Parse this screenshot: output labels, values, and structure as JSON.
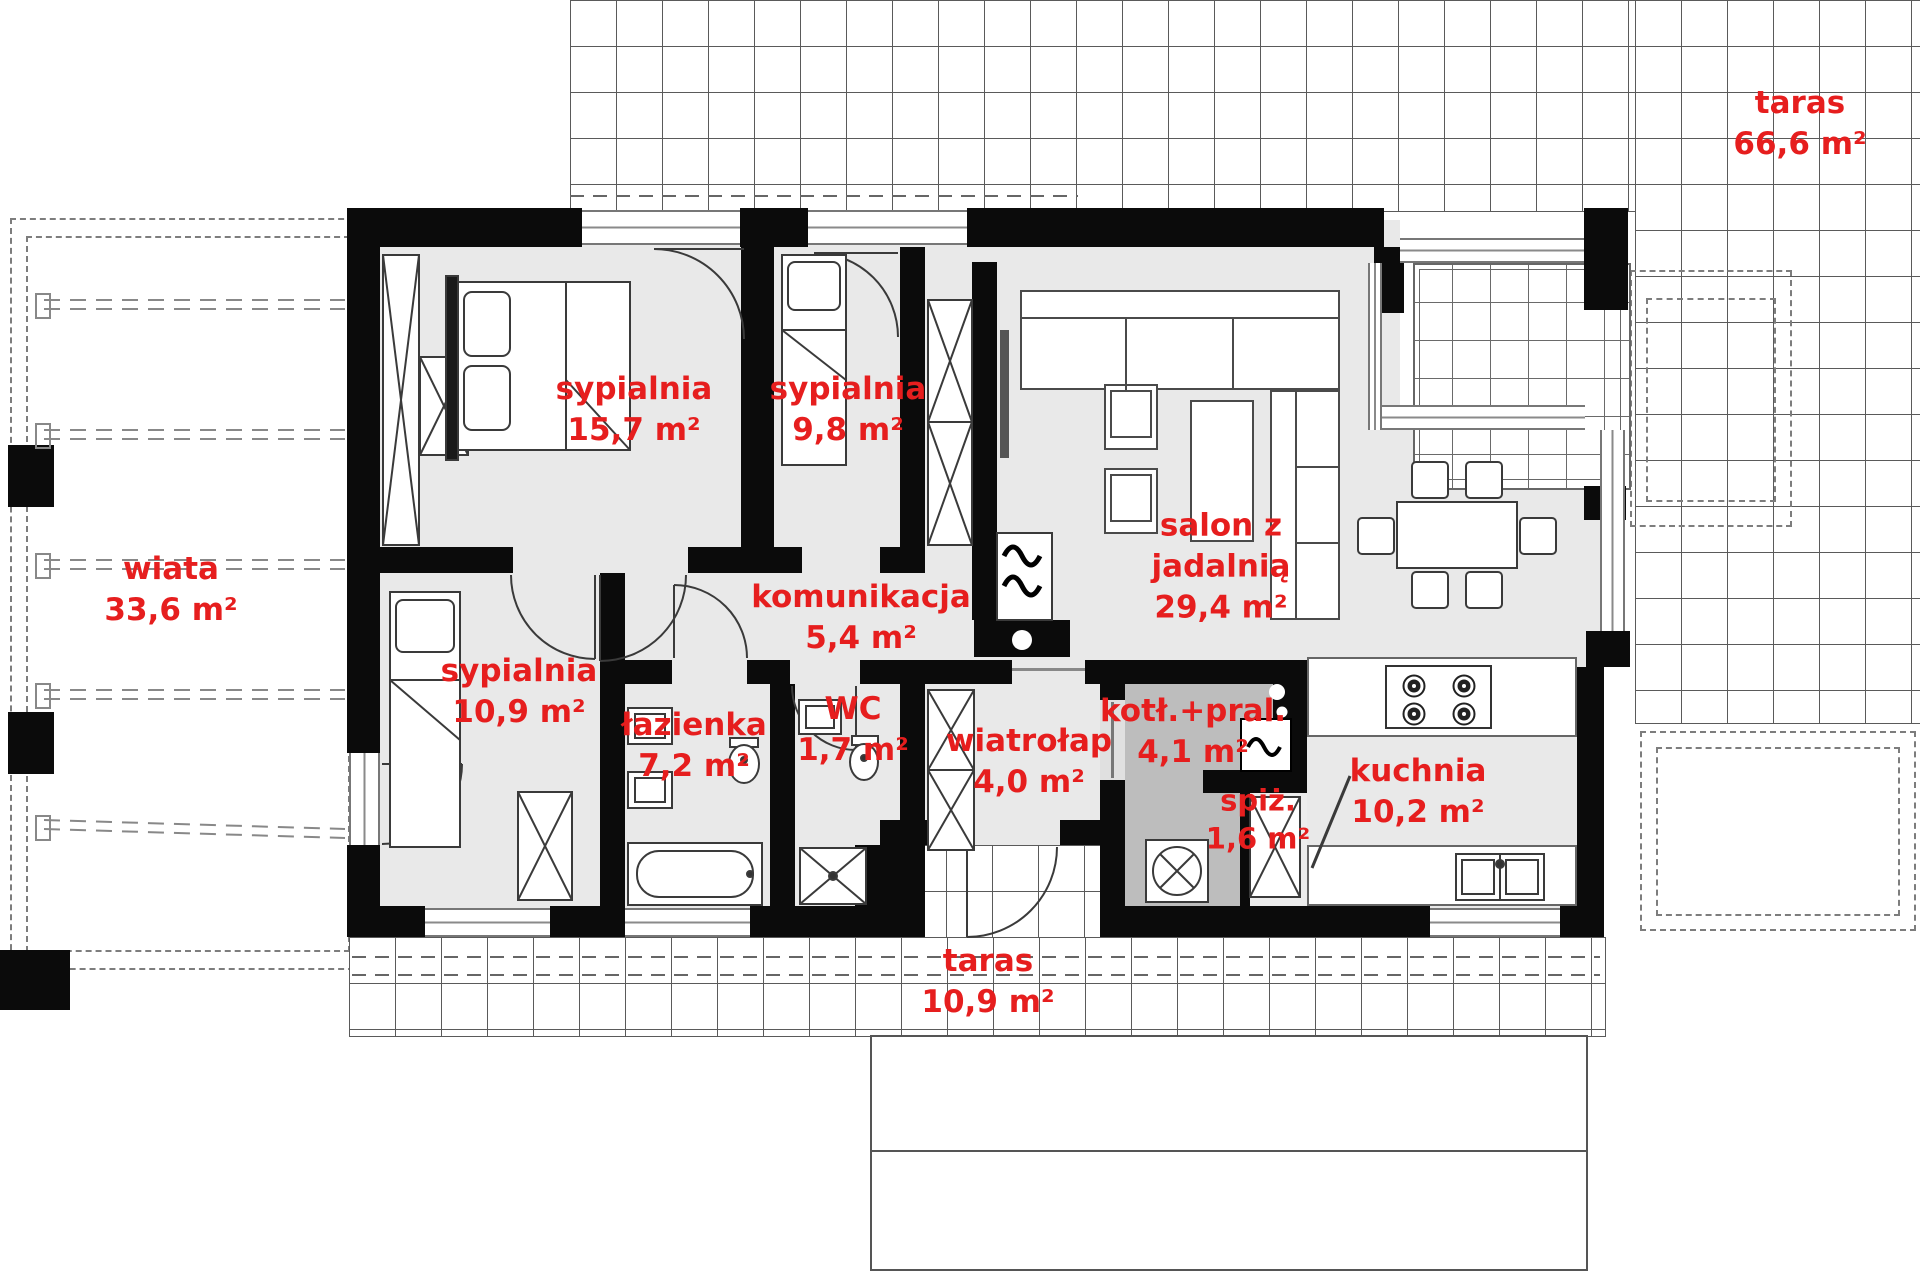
{
  "rooms": [
    {
      "name": "taras",
      "area": "66,6 m²"
    },
    {
      "name": "wiata",
      "area": "33,6 m²"
    },
    {
      "name": "sypialnia",
      "area": "15,7 m²"
    },
    {
      "name": "sypialnia",
      "area": "9,8 m²"
    },
    {
      "name": "salon z jadalnią",
      "area": "29,4 m²"
    },
    {
      "name": "komunikacja",
      "area": "5,4 m²"
    },
    {
      "name": "sypialnia",
      "area": "10,9 m²"
    },
    {
      "name": "łazienka",
      "area": "7,2 m²"
    },
    {
      "name": "WC",
      "area": "1,7 m²"
    },
    {
      "name": "wiatrołap",
      "area": "4,0 m²"
    },
    {
      "name": "kotł.+pral.",
      "area": "4,1 m²"
    },
    {
      "name": "spiż.",
      "area": "1,6 m²"
    },
    {
      "name": "kuchnia",
      "area": "10,2 m²"
    },
    {
      "name": "taras",
      "area": "10,9 m²"
    }
  ],
  "colors": {
    "label_red": "#e61e1e",
    "wall_black": "#0b0b0b",
    "floor_light": "#e9e9e9",
    "floor_utility": "#bdbdbd",
    "line_gray": "#5a5a5a"
  }
}
